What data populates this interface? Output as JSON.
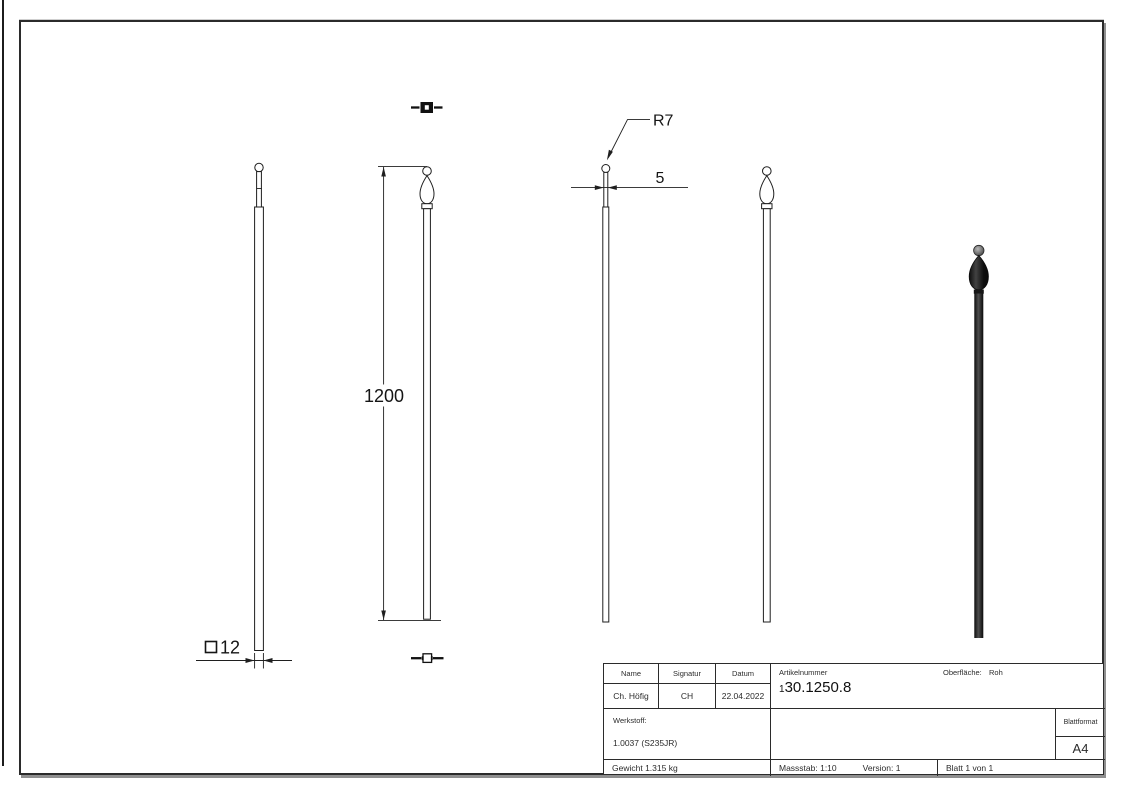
{
  "dimensions": {
    "length": "1200",
    "profile": "12",
    "tip_thickness": "5",
    "tip_radius": "R7"
  },
  "title_block": {
    "col_name": "Name",
    "col_signatur": "Signatur",
    "col_datum": "Datum",
    "name": "Ch. Höfig",
    "signatur": "CH",
    "datum": "22.04.2022",
    "artikelnummer_label": "Artikelnummer",
    "artikelnummer_prefix": "1",
    "artikelnummer": "30.1250.8",
    "oberflaeche_label": "Oberfläche:",
    "oberflaeche_value": "Roh",
    "werkstoff_label": "Werkstoff:",
    "werkstoff_value": "1.0037 (S235JR)",
    "blattformat_label": "Blattformat",
    "blattformat_value": "A4",
    "gewicht": "Gewicht 1.315 kg",
    "massstab": "Massstab: 1:10",
    "version": "Version: 1",
    "blatt": "Blatt 1 von 1"
  },
  "colors": {
    "line": "#1f1f1f",
    "render_dark": "#101010",
    "render_highlight": "#4e4e4e"
  }
}
